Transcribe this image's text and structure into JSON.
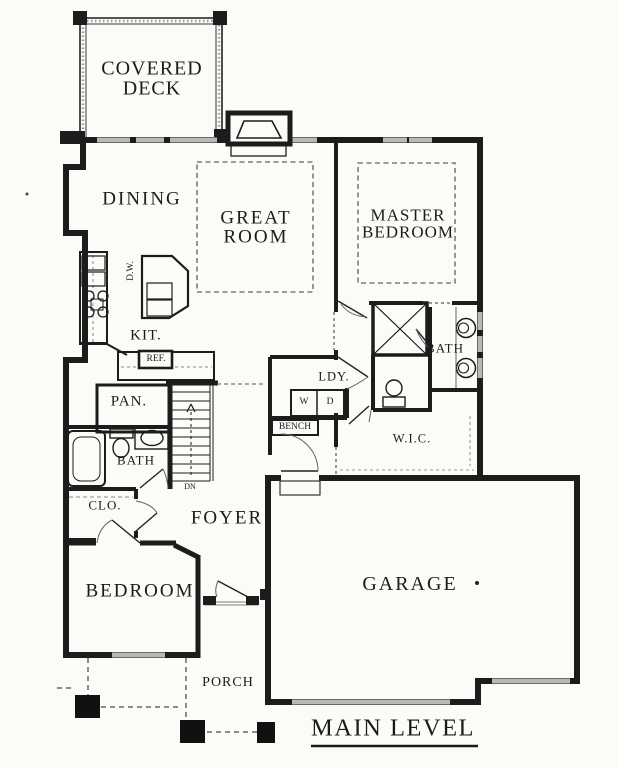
{
  "title": "MAIN LEVEL",
  "labels": {
    "covered_deck": "COVERED DECK",
    "dining": "DINING",
    "great_room": "GREAT ROOM",
    "master_bedroom": "MASTER BEDROOM",
    "kitchen": "KIT.",
    "dishwasher": "D.W.",
    "refrigerator": "REF.",
    "pantry": "PAN.",
    "laundry": "LDY.",
    "washer": "W",
    "dryer": "D",
    "bench": "BENCH",
    "master_bath": "BATH",
    "walk_in_closet": "W.I.C.",
    "hall_bath": "BATH",
    "closet": "CLO.",
    "stairs_direction": "DN",
    "foyer": "FOYER",
    "bedroom": "BEDROOM",
    "garage": "GARAGE",
    "porch": "PORCH"
  },
  "colors": {
    "wall": "#1c1c1c",
    "window_gray": "#b8b8b6",
    "dash_gray": "#7c7c7c",
    "background": "#fbfbf8",
    "text": "#1b1b1b"
  }
}
